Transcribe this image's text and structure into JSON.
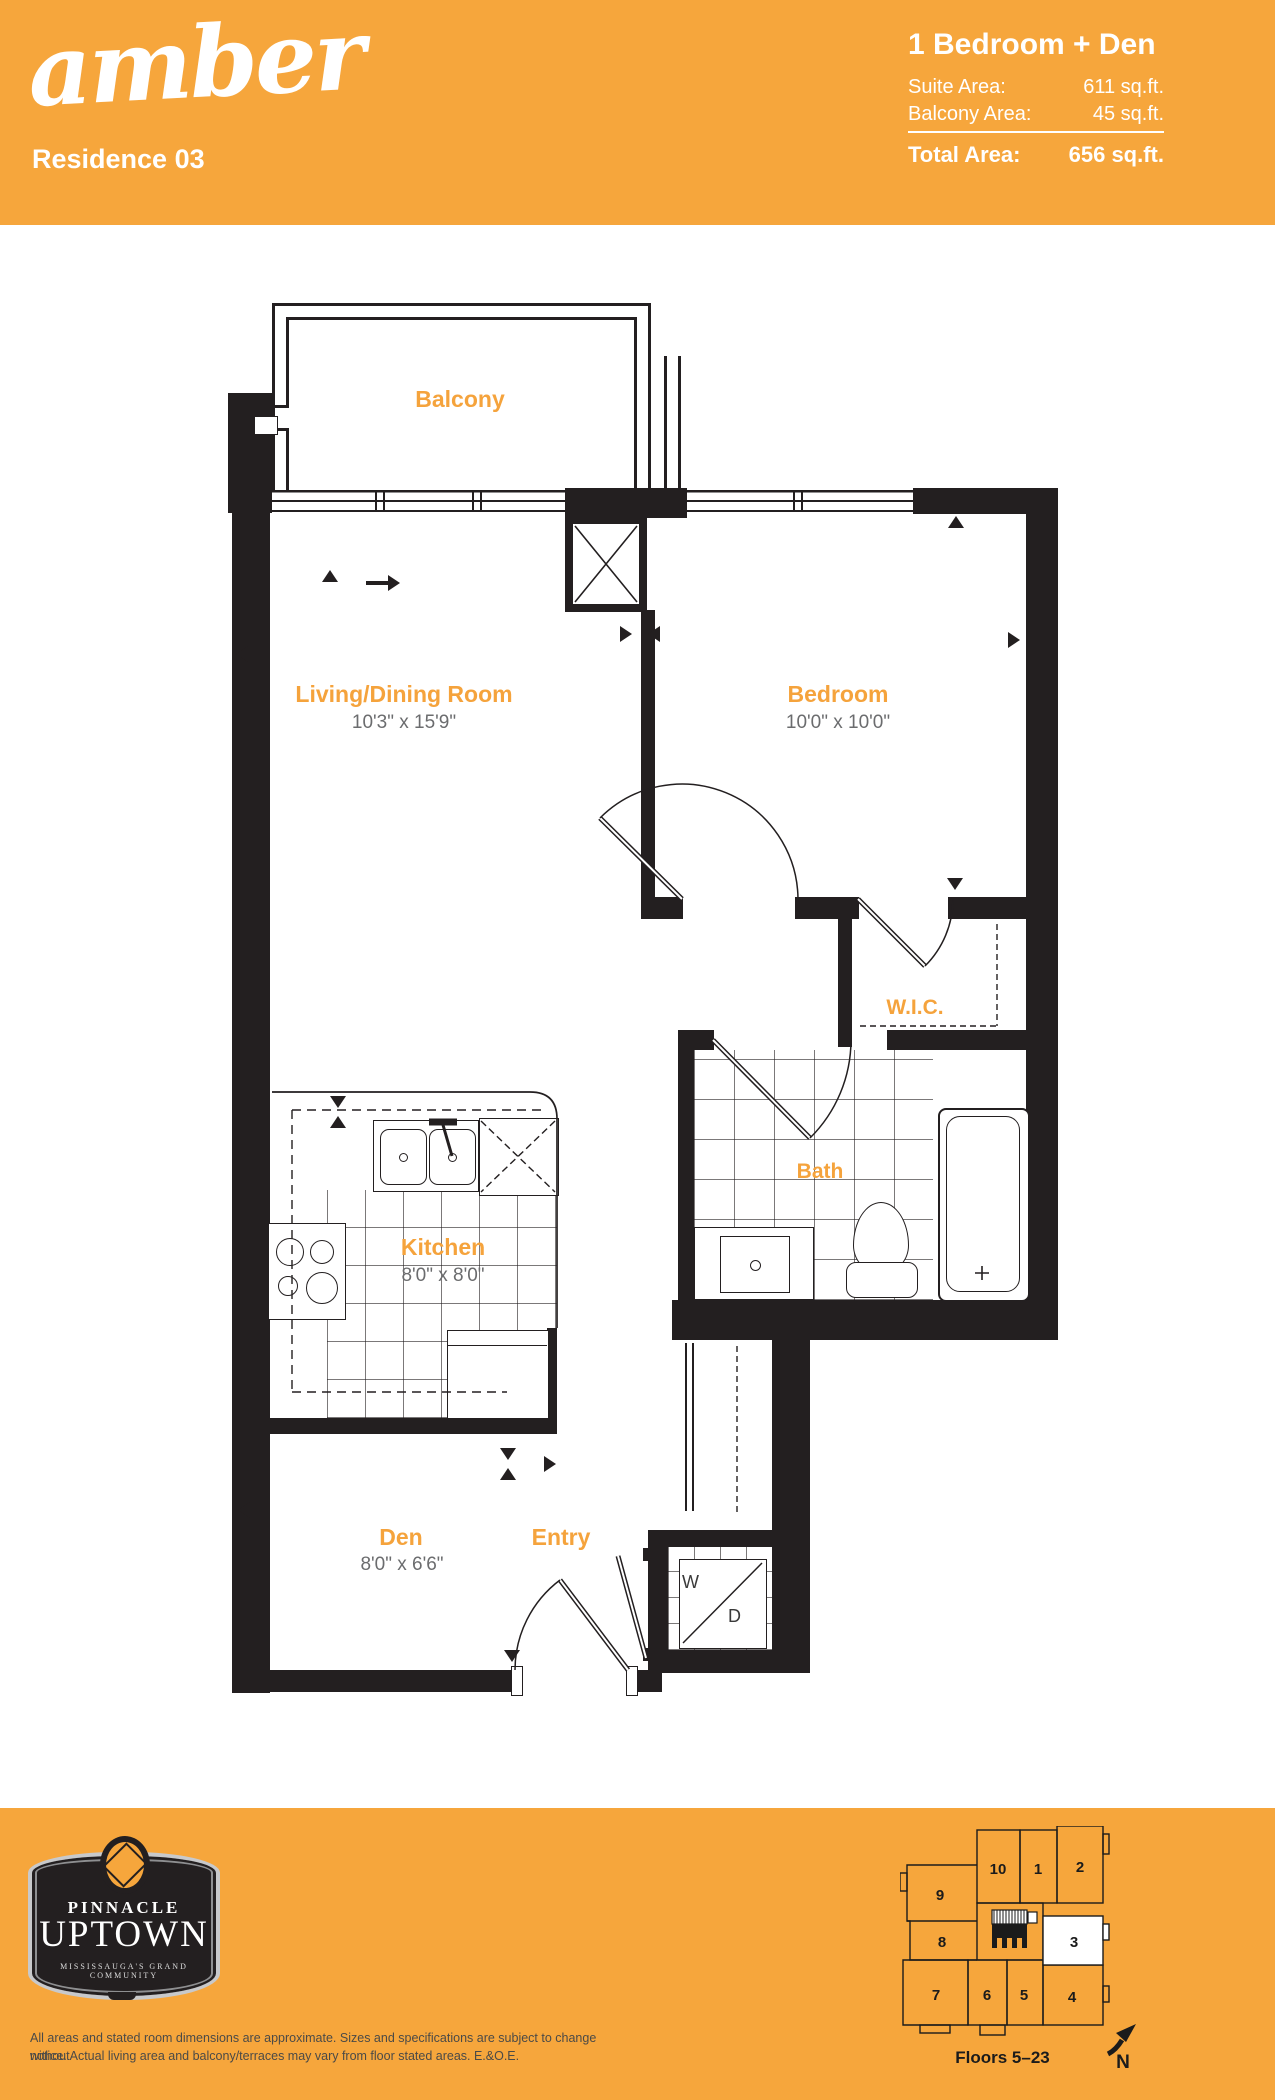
{
  "header": {
    "brand": "amber",
    "residence": "Residence 03",
    "unit_type": "1 Bedroom + Den",
    "suite_area_label": "Suite Area:",
    "suite_area_value": "611 sq.ft.",
    "balcony_area_label": "Balcony Area:",
    "balcony_area_value": "45 sq.ft.",
    "total_area_label": "Total Area:",
    "total_area_value": "656 sq.ft."
  },
  "floorplan": {
    "rooms": [
      {
        "name": "Balcony",
        "dims": ""
      },
      {
        "name": "Living/Dining Room",
        "dims": "10'3\" x 15'9\""
      },
      {
        "name": "Bedroom",
        "dims": "10'0\" x 10'0\""
      },
      {
        "name": "W.I.C.",
        "dims": ""
      },
      {
        "name": "Bath",
        "dims": ""
      },
      {
        "name": "Kitchen",
        "dims": "8'0\" x 8'0\""
      },
      {
        "name": "Den",
        "dims": "8'0\" x 6'6\""
      },
      {
        "name": "Entry",
        "dims": ""
      }
    ],
    "appliances": {
      "washer": "W",
      "dryer": "D"
    }
  },
  "footer": {
    "logo": {
      "line1": "PINNACLE",
      "line2": "UPTOWN",
      "tagline": "MISSISSAUGA'S GRAND COMMUNITY"
    },
    "disclaimer_line1": "All areas and stated room dimensions are approximate. Sizes and specifications are subject to change without",
    "disclaimer_line2": "notice. Actual living area and balcony/terraces may vary from floor stated areas. E.&O.E.",
    "keyplan": {
      "units": [
        "10",
        "1",
        "2",
        "9",
        "8",
        "3",
        "7",
        "6",
        "5",
        "4"
      ],
      "highlighted_unit": "3",
      "floors": "Floors 5–23",
      "north": "N"
    }
  },
  "colors": {
    "brand_orange": "#F6A63C",
    "wall_black": "#231F20",
    "room_label_orange": "#F5A33C",
    "dims_gray": "#6B6C6E",
    "logo_silver": "#C8C9CB"
  }
}
